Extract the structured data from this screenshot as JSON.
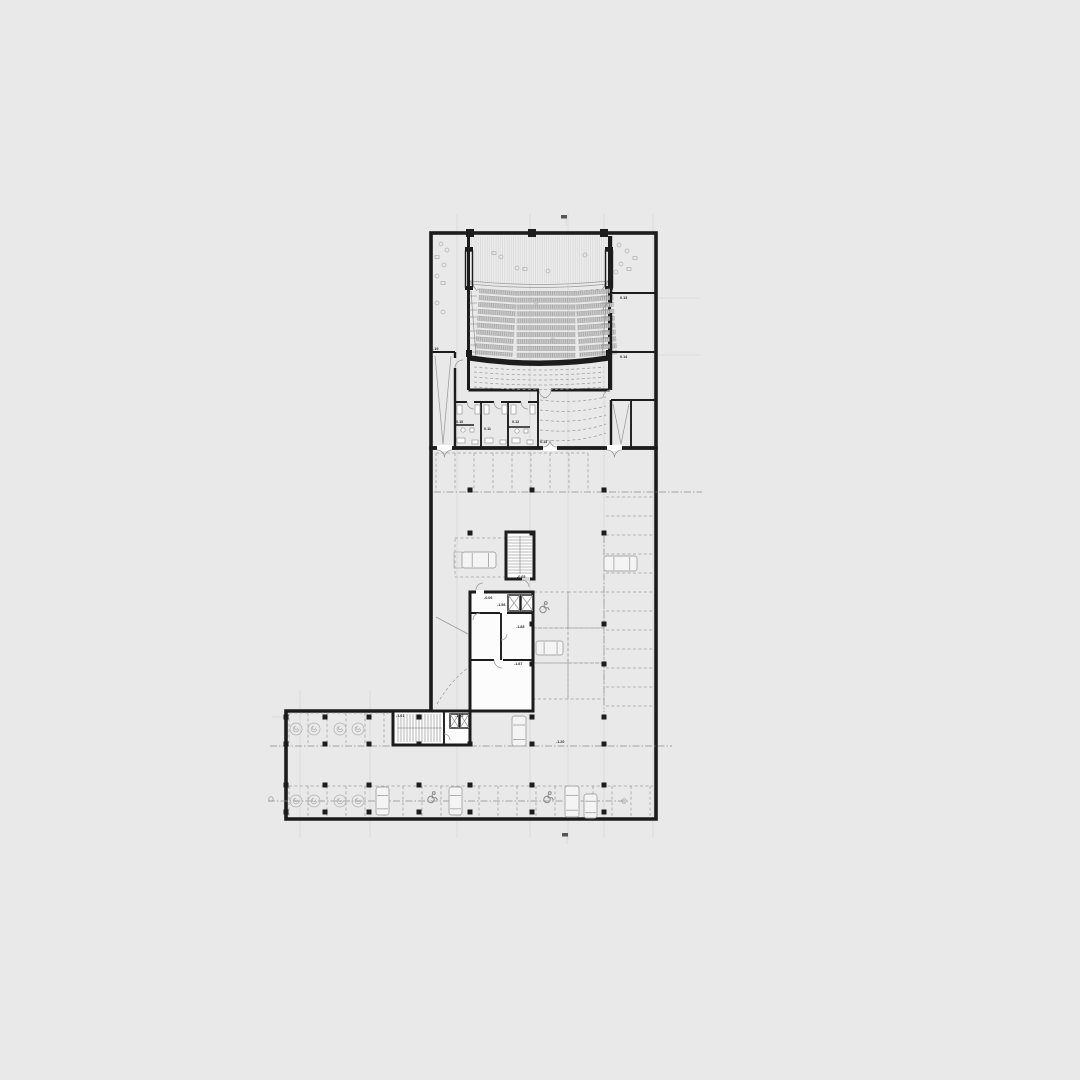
{
  "colors": {
    "page_bg": "#e9e9e9",
    "plan_white": "#fbfbfb",
    "garage_fill": "#d8d8d8",
    "wall": "#1c1c1c",
    "line_light": "#9a9a9a",
    "dashed_line": "#9e9e9e",
    "seat_fill": "#c9c9c9",
    "label": "#2b2b2b"
  },
  "labels": [
    {
      "text": "-1.19",
      "x": 430,
      "y": 350
    },
    {
      "text": "0.13",
      "x": 620,
      "y": 299
    },
    {
      "text": "0.14",
      "x": 620,
      "y": 358
    },
    {
      "text": "0.10",
      "x": 456,
      "y": 423
    },
    {
      "text": "0.11",
      "x": 484,
      "y": 430
    },
    {
      "text": "0.12",
      "x": 512,
      "y": 423
    },
    {
      "text": "0.13",
      "x": 540,
      "y": 443
    },
    {
      "text": "-0.05",
      "x": 517,
      "y": 578
    },
    {
      "text": "-0.06",
      "x": 484,
      "y": 599
    },
    {
      "text": "-1.58",
      "x": 497,
      "y": 606
    },
    {
      "text": "-1.88",
      "x": 516,
      "y": 628
    },
    {
      "text": "-1.87",
      "x": 514,
      "y": 665
    },
    {
      "text": "-1.01",
      "x": 396,
      "y": 717
    },
    {
      "text": "-1.02",
      "x": 455,
      "y": 717
    },
    {
      "text": "-1.20",
      "x": 556,
      "y": 743
    }
  ],
  "columns": [
    [
      470,
      490
    ],
    [
      532,
      490
    ],
    [
      604,
      490
    ],
    [
      470,
      533
    ],
    [
      532,
      533
    ],
    [
      604,
      533
    ],
    [
      532,
      624
    ],
    [
      604,
      624
    ],
    [
      532,
      664
    ],
    [
      604,
      664
    ],
    [
      286,
      717
    ],
    [
      325,
      717
    ],
    [
      369,
      717
    ],
    [
      419,
      717
    ],
    [
      532,
      717
    ],
    [
      604,
      717
    ],
    [
      286,
      744
    ],
    [
      325,
      744
    ],
    [
      369,
      744
    ],
    [
      419,
      744
    ],
    [
      470,
      744
    ],
    [
      532,
      744
    ],
    [
      604,
      744
    ],
    [
      286,
      785
    ],
    [
      325,
      785
    ],
    [
      369,
      785
    ],
    [
      419,
      785
    ],
    [
      470,
      785
    ],
    [
      532,
      785
    ],
    [
      604,
      785
    ],
    [
      286,
      812
    ],
    [
      325,
      812
    ],
    [
      369,
      812
    ],
    [
      419,
      812
    ],
    [
      470,
      812
    ],
    [
      532,
      812
    ],
    [
      604,
      812
    ]
  ],
  "moto_spirals": [
    [
      296,
      729
    ],
    [
      314,
      729
    ],
    [
      340,
      729
    ],
    [
      358,
      729
    ],
    [
      296,
      801
    ],
    [
      314,
      801
    ],
    [
      340,
      801
    ],
    [
      358,
      801
    ]
  ],
  "cars": [
    {
      "x": 462,
      "y": 552,
      "o": "h",
      "l": 34,
      "w": 16
    },
    {
      "x": 604,
      "y": 556,
      "o": "h",
      "l": 33,
      "w": 15
    },
    {
      "x": 536,
      "y": 641,
      "o": "h",
      "l": 27,
      "w": 14
    },
    {
      "x": 512,
      "y": 716,
      "o": "v",
      "l": 30,
      "w": 14
    },
    {
      "x": 376,
      "y": 787,
      "o": "v",
      "l": 28,
      "w": 13
    },
    {
      "x": 449,
      "y": 787,
      "o": "v",
      "l": 28,
      "w": 13
    },
    {
      "x": 565,
      "y": 786,
      "o": "v",
      "l": 31,
      "w": 14
    },
    {
      "x": 584,
      "y": 794,
      "o": "v",
      "l": 24,
      "w": 13
    }
  ],
  "accessible_spots": [
    [
      543,
      607
    ],
    [
      431,
      797
    ],
    [
      547,
      797
    ]
  ],
  "stalls": {
    "v_groups": [
      {
        "y1": 453,
        "y2": 491,
        "xs": [
          436,
          455,
          474,
          493,
          512,
          531,
          550,
          569,
          588
        ],
        "capx": [
          436,
          588
        ]
      },
      {
        "y1": 713,
        "y2": 745,
        "xs": [
          289,
          308,
          327,
          346,
          365,
          384
        ],
        "capx": [
          289,
          392
        ]
      },
      {
        "y1": 786,
        "y2": 817,
        "xs": [
          289,
          308,
          327,
          346,
          365,
          384,
          403,
          422,
          441,
          460,
          479,
          498,
          517,
          536,
          555,
          574,
          593,
          612,
          631,
          650
        ],
        "capx": [
          289,
          653
        ]
      }
    ],
    "h_groups": [
      {
        "x1": 606,
        "x2": 654,
        "ys": [
          497,
          516,
          535,
          554,
          573,
          592,
          611,
          630,
          649,
          668,
          687,
          706
        ]
      }
    ],
    "rects": [
      [
        455,
        538,
        52,
        39
      ],
      [
        534,
        592,
        34,
        36
      ],
      [
        568,
        592,
        36,
        36
      ],
      [
        534,
        628,
        34,
        35
      ],
      [
        568,
        628,
        36,
        35
      ],
      [
        534,
        663,
        34,
        36
      ],
      [
        568,
        663,
        36,
        36
      ]
    ]
  },
  "centerlines": [
    {
      "x1": 434,
      "y1": 492,
      "x2": 702,
      "y2": 492
    },
    {
      "x1": 270,
      "y1": 746,
      "x2": 672,
      "y2": 746
    },
    {
      "x1": 268,
      "y1": 801,
      "x2": 628,
      "y2": 801
    },
    {
      "x1": 604,
      "y1": 536,
      "x2": 604,
      "y2": 712
    }
  ],
  "grid": {
    "v": [
      {
        "x": 300,
        "y1": 690,
        "y2": 838
      },
      {
        "x": 370,
        "y1": 690,
        "y2": 838
      },
      {
        "x": 457,
        "y1": 214,
        "y2": 838
      },
      {
        "x": 530,
        "y1": 214,
        "y2": 838
      },
      {
        "x": 568,
        "y1": 212,
        "y2": 840
      },
      {
        "x": 604,
        "y1": 214,
        "y2": 838
      },
      {
        "x": 653,
        "y1": 214,
        "y2": 838
      }
    ],
    "h": [
      {
        "y": 298,
        "x1": 657,
        "x2": 700
      },
      {
        "y": 355,
        "x1": 657,
        "x2": 700
      },
      {
        "y": 717,
        "x1": 272,
        "x2": 287
      }
    ]
  },
  "axis_marks": [
    {
      "x": 566,
      "y": 218,
      "k": "flag"
    },
    {
      "x": 567,
      "y": 836,
      "k": "flag"
    },
    {
      "x": 271,
      "y": 799,
      "k": "ring"
    },
    {
      "x": 624,
      "y": 801,
      "k": "ring"
    }
  ],
  "furniture": [
    {
      "x": 441,
      "y": 244,
      "k": "c"
    },
    {
      "x": 447,
      "y": 250,
      "k": "c"
    },
    {
      "x": 437,
      "y": 257,
      "k": "r"
    },
    {
      "x": 444,
      "y": 265,
      "k": "c"
    },
    {
      "x": 437,
      "y": 276,
      "k": "c"
    },
    {
      "x": 443,
      "y": 283,
      "k": "r"
    },
    {
      "x": 437,
      "y": 303,
      "k": "c"
    },
    {
      "x": 443,
      "y": 312,
      "k": "c"
    },
    {
      "x": 619,
      "y": 245,
      "k": "c"
    },
    {
      "x": 627,
      "y": 251,
      "k": "c"
    },
    {
      "x": 635,
      "y": 258,
      "k": "r"
    },
    {
      "x": 621,
      "y": 264,
      "k": "c"
    },
    {
      "x": 616,
      "y": 272,
      "k": "c"
    },
    {
      "x": 629,
      "y": 269,
      "k": "r"
    },
    {
      "x": 494,
      "y": 253,
      "k": "r"
    },
    {
      "x": 501,
      "y": 257,
      "k": "c"
    },
    {
      "x": 517,
      "y": 268,
      "k": "c"
    },
    {
      "x": 525,
      "y": 269,
      "k": "r"
    },
    {
      "x": 548,
      "y": 271,
      "k": "c"
    },
    {
      "x": 585,
      "y": 255,
      "k": "c"
    },
    {
      "x": 536,
      "y": 302,
      "k": "c"
    },
    {
      "x": 553,
      "y": 340,
      "k": "c"
    }
  ]
}
